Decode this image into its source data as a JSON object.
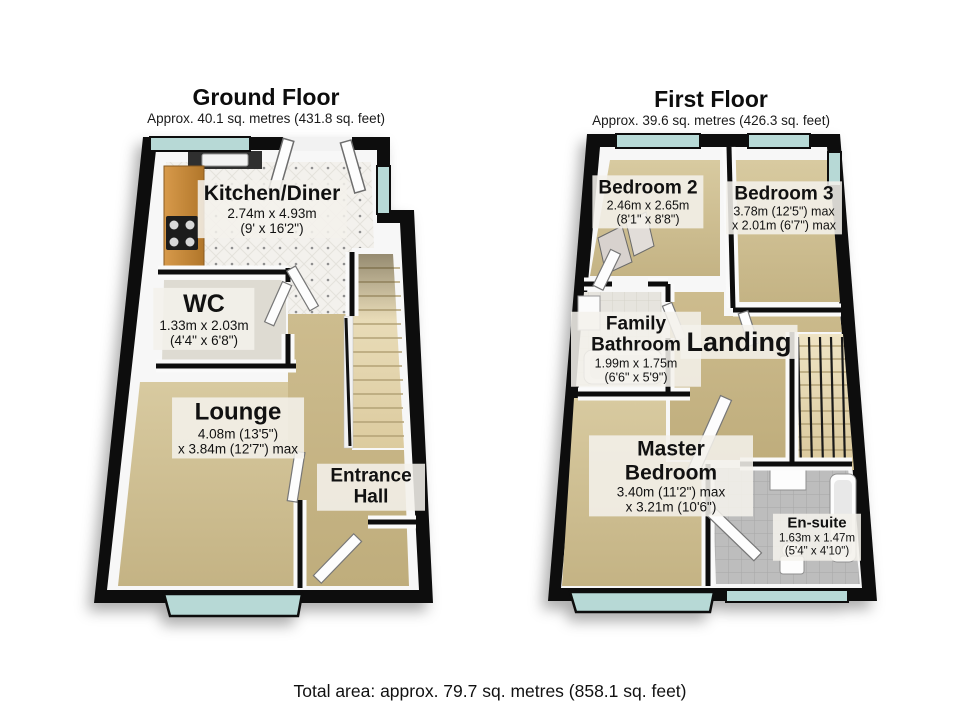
{
  "ground_floor": {
    "title": "Ground Floor",
    "subtitle": "Approx. 40.1 sq. metres (431.8 sq. feet)",
    "rooms": {
      "kitchen": {
        "name": "Kitchen/Diner",
        "dim_metric": "2.74m x 4.93m",
        "dim_imperial": "(9' x 16'2\")"
      },
      "wc": {
        "name": "WC",
        "dim_metric": "1.33m x 2.03m",
        "dim_imperial": "(4'4\" x 6'8\")"
      },
      "lounge": {
        "name": "Lounge",
        "dim_metric": "4.08m (13'5\")",
        "dim_imperial": "x 3.84m (12'7\") max"
      },
      "entrance_hall": {
        "name": "Entrance Hall"
      }
    }
  },
  "first_floor": {
    "title": "First Floor",
    "subtitle": "Approx. 39.6 sq. metres (426.3 sq. feet)",
    "rooms": {
      "bedroom2": {
        "name": "Bedroom 2",
        "dim_metric": "2.46m x 2.65m",
        "dim_imperial": "(8'1\" x 8'8\")"
      },
      "bedroom3": {
        "name": "Bedroom 3",
        "dim_metric": "3.78m (12'5\") max",
        "dim_imperial": "x 2.01m (6'7\") max"
      },
      "family_bathroom": {
        "name": "Family Bathroom",
        "dim_metric": "1.99m x 1.75m",
        "dim_imperial": "(6'6\" x 5'9\")"
      },
      "landing": {
        "name": "Landing"
      },
      "master_bedroom": {
        "name": "Master Bedroom",
        "dim_metric": "3.40m (11'2\") max",
        "dim_imperial": "x 3.21m (10'6\")"
      },
      "ensuite": {
        "name": "En-suite",
        "dim_metric": "1.63m x 1.47m",
        "dim_imperial": "(5'4\" x 4'10\")"
      }
    }
  },
  "footer": {
    "total_area": "Total area: approx. 79.7 sq. metres (858.1 sq. feet)"
  },
  "palette": {
    "wall": "#0d0d0d",
    "wall_face": "#f7f7f7",
    "carpet_beige": "#cdbc92",
    "hall_carpet": "#c4b284",
    "kitchen_tile": "#f3f1ed",
    "wood_counter": "#c8893c",
    "window_glass": "#b7d9d6",
    "stairs": "#e8dcba",
    "ensuite_tile": "#bdbdbd",
    "label_background": "rgba(243,241,235,0.87)"
  }
}
